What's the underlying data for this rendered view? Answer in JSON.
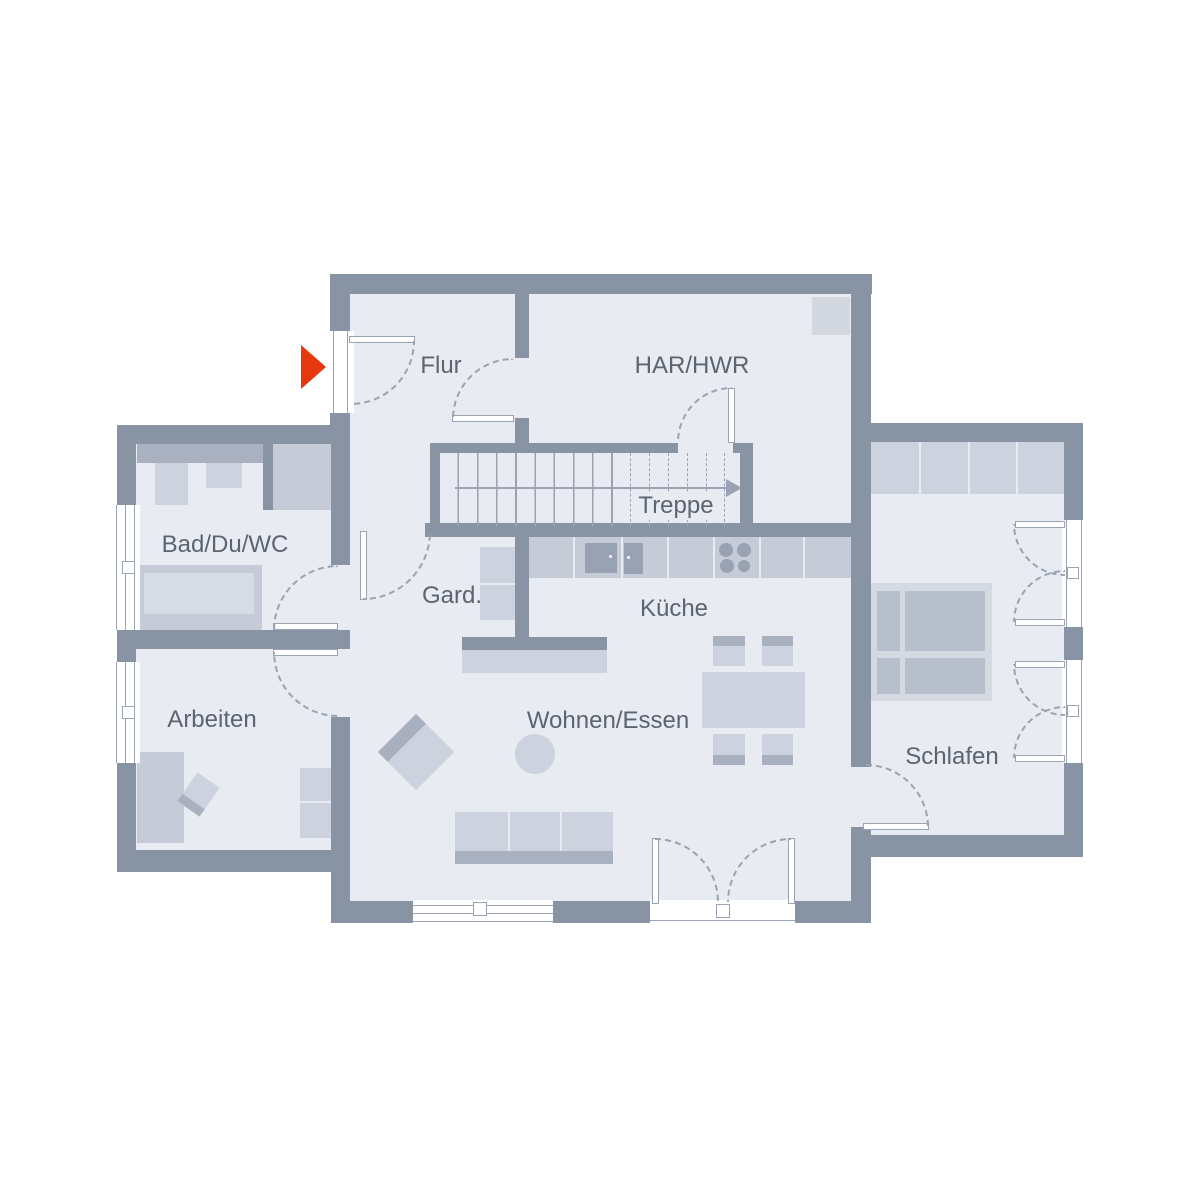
{
  "labels": {
    "flur": "Flur",
    "har_hwr": "HAR/HWR",
    "treppe": "Treppe",
    "bad": "Bad/Du/WC",
    "gard": "Gard.",
    "kueche": "Küche",
    "arbeiten": "Arbeiten",
    "wohnen_essen": "Wohnen/Essen",
    "schlafen": "Schlafen"
  },
  "colors": {
    "wall": "#8893A3",
    "floor": "#E8EBF1",
    "furn_light": "#CDD3DE",
    "furn_mid": "#C6CCD7",
    "furn_dark": "#A9B1C0",
    "appliance": "#99A2B2",
    "line": "#9AA3B3",
    "text": "#5B6470",
    "accent_red": "#E6380F"
  },
  "stairs": {
    "direction": "up-to-the-right"
  },
  "entrance": {
    "marker": "red-arrow-pointing-right"
  }
}
